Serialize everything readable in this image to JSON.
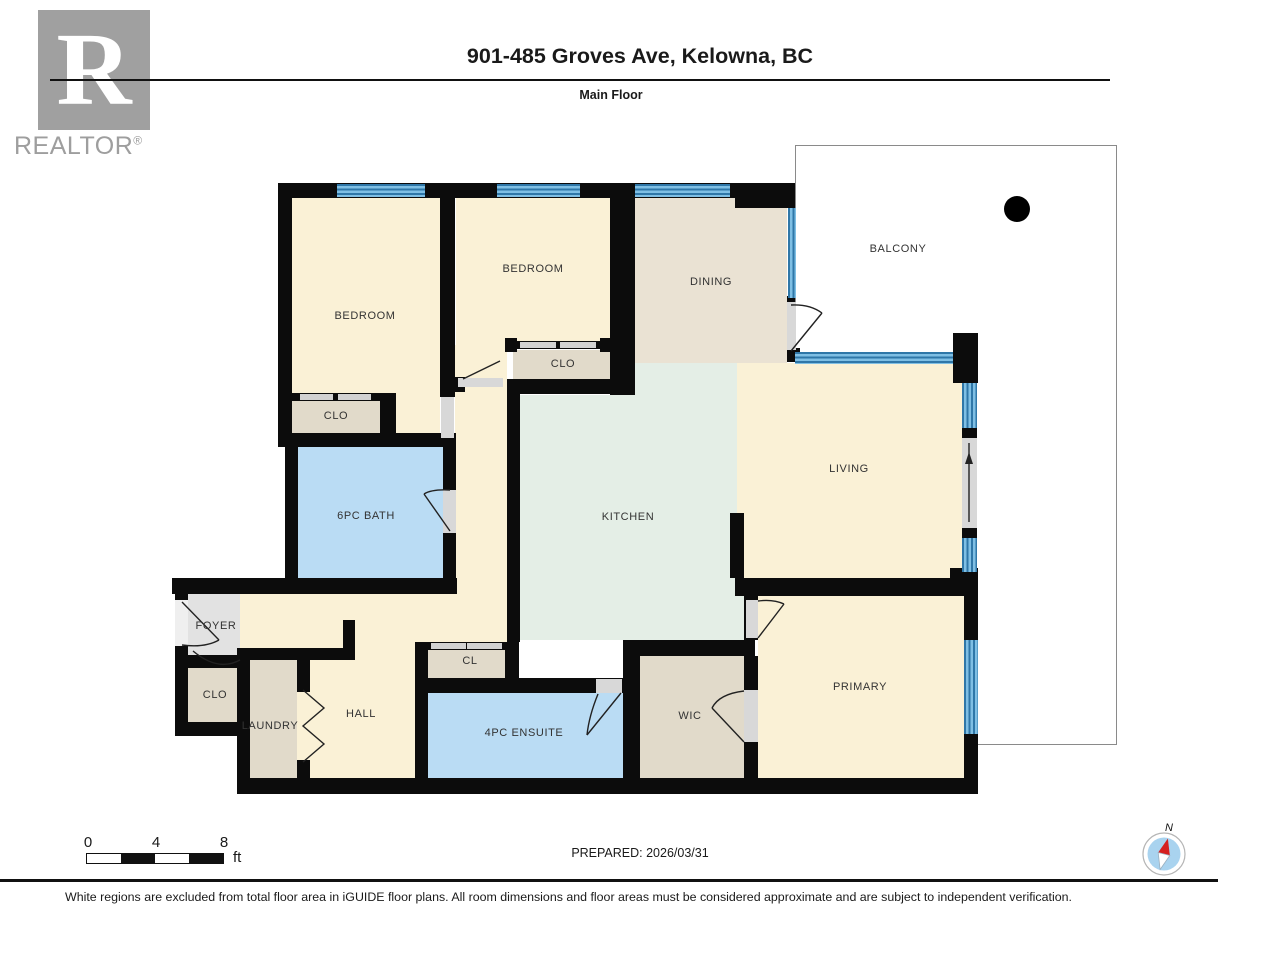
{
  "header": {
    "title": "901-485 Groves Ave, Kelowna, BC",
    "subtitle": "Main Floor",
    "logo_letter": "R",
    "logo_caption": "REALTOR",
    "logo_registered": "®"
  },
  "rooms": {
    "bedroom1": "BEDROOM",
    "bedroom2": "BEDROOM",
    "clo1": "CLO",
    "clo2": "CLO",
    "dining": "DINING",
    "balcony": "BALCONY",
    "living": "LIVING",
    "kitchen": "KITCHEN",
    "bath": "6PC BATH",
    "foyer": "FOYER",
    "clo3": "CLO",
    "laundry": "LAUNDRY",
    "hall": "HALL",
    "cl": "CL",
    "ensuite": "4PC ENSUITE",
    "wic": "WIC",
    "primary": "PRIMARY"
  },
  "plan": {
    "compass_label": "N"
  },
  "scale_bar": {
    "ticks": [
      "0",
      "4",
      "8"
    ],
    "unit": "ft"
  },
  "footer": {
    "prepared_label": "PREPARED: 2026/03/31",
    "disclaimer": "White regions are excluded from total floor area in iGUIDE floor plans. All room dimensions and floor areas must be considered approximate and are subject to independent verification."
  },
  "colors": {
    "wall": "#0c0c0c",
    "room-cream": "#FAF1D6",
    "room-tan": "#E1DACA",
    "room-dining": "#EAE2D3",
    "room-green": "#E4EEE6",
    "room-blue": "#BADCF4",
    "room-gray": "#E2E2E2",
    "window-blue": "#7FBFE4",
    "window-dark": "#2F77A8",
    "door-gray": "#D8D8D8",
    "balcony-border": "#8A8A8A",
    "logo-gray": "#A0A0A0",
    "text": "#1A1A1A"
  }
}
